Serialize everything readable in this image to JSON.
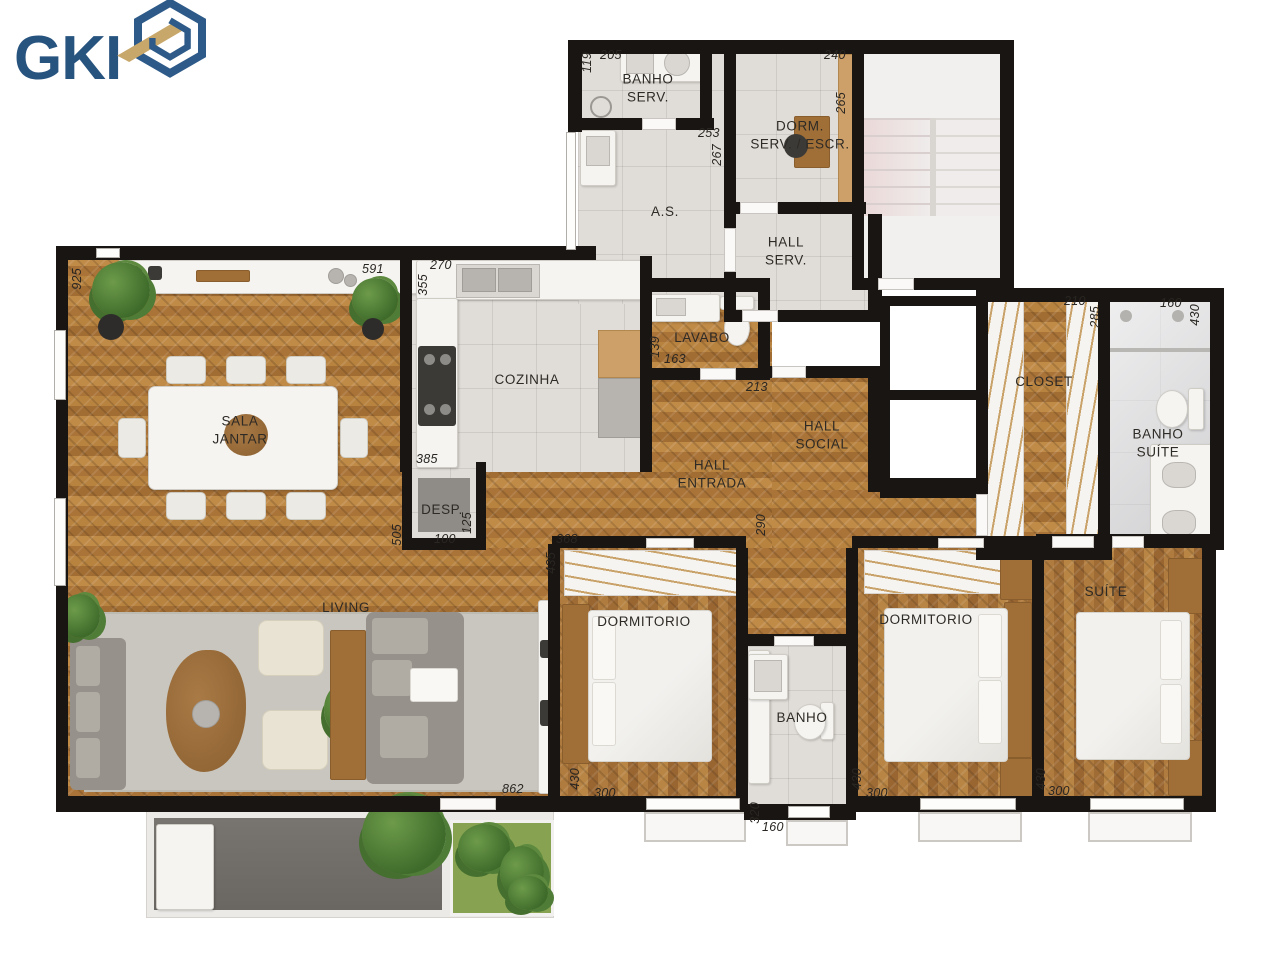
{
  "logo": {
    "text": "GKI"
  },
  "rooms": {
    "banho_serv": "BANHO\nSERV.",
    "dorm_serv": "DORM.\nSERV. / ESCR.",
    "as": "A.S.",
    "hall_serv": "HALL\nSERV.",
    "cozinha": "COZINHA",
    "lavabo": "LAVABO",
    "sala_jantar": "SALA\nJANTAR",
    "hall_social": "HALL\nSOCIAL",
    "hall_entrada": "HALL\nENTRADA",
    "closet": "CLOSET",
    "banho_suite": "BANHO\nSUÍTE",
    "desp": "DESP.",
    "living": "LIVING",
    "dormitorio1": "DORMITORIO",
    "dormitorio2": "DORMITORIO",
    "suite": "SUÍTE",
    "banho": "BANHO"
  },
  "dims": {
    "sala_left": "925",
    "sala_top": "591",
    "cozinha_top": "270",
    "cozinha_left": "355",
    "banho_serv_left": "119",
    "banho_serv_top": "205",
    "dorm_serv_top": "240",
    "dorm_serv_right": "265",
    "as_w": "253",
    "as_h": "267",
    "lavabo_left": "139",
    "lavabo_w": "163",
    "hall_entrada_right": "213",
    "desp_top": "385",
    "desp_left": "505",
    "desp_w": "100",
    "desp_h": "125",
    "dorm1_top": "368",
    "dorm1_left": "435",
    "corridor": "290",
    "closet_top": "210",
    "closet_right": "285",
    "banho_suite_top": "160",
    "banho_suite_right": "430",
    "dorm1_h": "430",
    "dorm1_w": "300",
    "banho_h": "320",
    "banho_w": "160",
    "dorm2_h": "430",
    "dorm2_w": "300",
    "suite_h": "430",
    "suite_w": "300",
    "living_w": "862"
  },
  "colors": {
    "wall": "#181512",
    "wood": "#b5803f",
    "tile": "#e0dcd7",
    "logo_blue": "#27537f",
    "logo_gold": "#c8a76a",
    "terrace": "#716d69",
    "garden": "#83a050"
  }
}
